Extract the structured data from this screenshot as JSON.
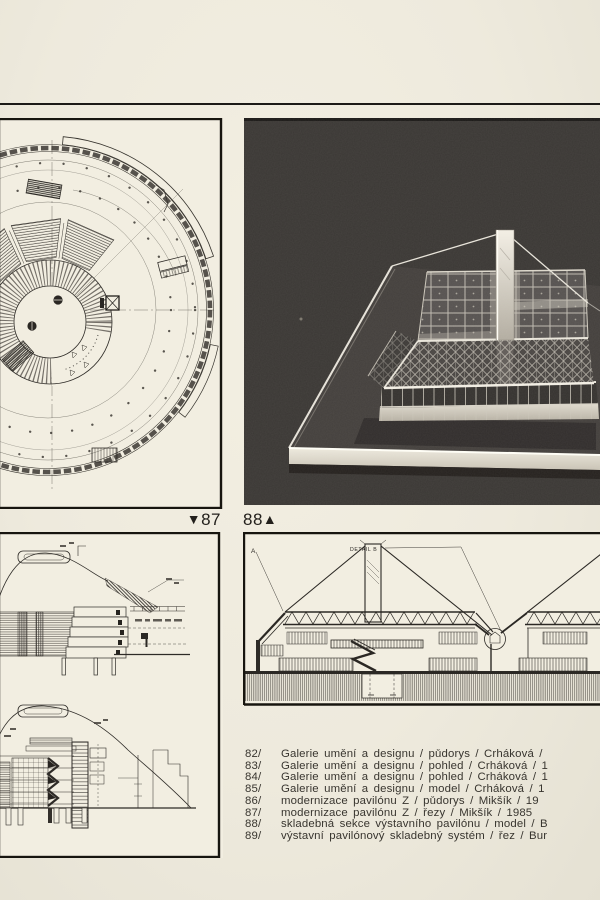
{
  "page_type": "architecture publication page (scanned)",
  "colors": {
    "paper": "#eeeadd",
    "panel_paper": "#f2eee1",
    "ink": "#2b2824",
    "photo_background": "#3a3734",
    "model_highlight": "#e9e5da"
  },
  "figure_refs": {
    "left": {
      "arrow": "▼",
      "number": "87"
    },
    "right": {
      "number": "88",
      "arrow": "▲"
    }
  },
  "drawing89": {
    "label_a": "A",
    "label_detail_b": "DETAIL B"
  },
  "captions": {
    "items": [
      {
        "num": "82/",
        "text": "Galerie umění a designu / půdorys / Crháková /"
      },
      {
        "num": "83/",
        "text": "Galerie umění a designu / pohled / Crháková / 1"
      },
      {
        "num": "84/",
        "text": "Galerie umění a designu / pohled / Crháková / 1"
      },
      {
        "num": "85/",
        "text": "Galerie umění a designu / model / Crháková / 1"
      },
      {
        "num": "86/",
        "text": "modernizace pavilónu Z / půdorys / Mikšík / 19"
      },
      {
        "num": "87/",
        "text": "modernizace pavilónu Z / řezy / Mikšík / 1985"
      },
      {
        "num": "88/",
        "text": "skladebná sekce výstavního pavilónu / model / B"
      },
      {
        "num": "89/",
        "text": "výstavní pavilónový skladebný systém / řez / Bur"
      }
    ]
  }
}
